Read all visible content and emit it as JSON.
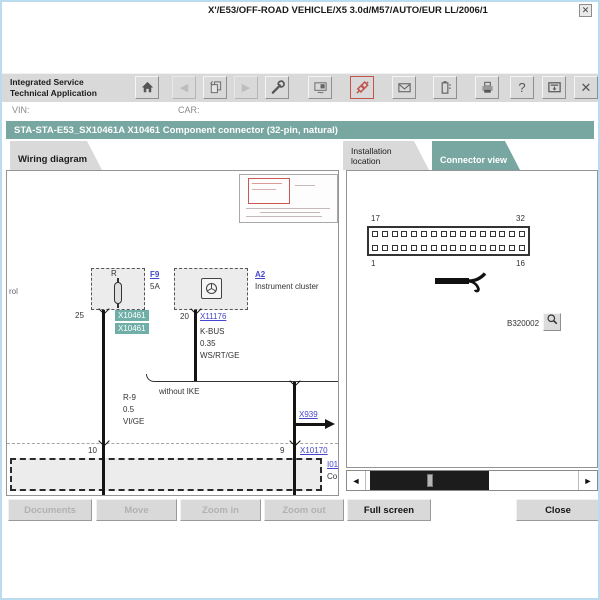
{
  "header": {
    "app_title_line1": "Integrated Service",
    "app_title_line2": "Technical Application",
    "toolbar": {
      "back_glyph": "◀",
      "forward_glyph": "▶",
      "help_glyph": "?",
      "close_glyph": "✕"
    }
  },
  "vehicle_bar": {
    "vin_label": "VIN:",
    "car_label": "CAR:",
    "car_value": "X'/E53/OFF-ROAD VEHICLE/X5 3.0d/M57/AUTO/EUR LL/2006/1"
  },
  "title_bar": {
    "title": "STA-STA-E53_SX10461A X10461 Component connector (32-pin, natural)",
    "close_glyph": "✕"
  },
  "tabs": {
    "wiring_diagram": {
      "label": "Wiring diagram"
    },
    "installation_location": {
      "label": "Installation location"
    },
    "connector_view": {
      "label": "Connector view"
    }
  },
  "wiring_panel": {
    "margin_note": "rol",
    "fuse": {
      "terminal": "R",
      "ref": "F9",
      "rating": "5A",
      "pin": "25",
      "highlight1": "X10461",
      "highlight2": "X10461"
    },
    "cluster": {
      "ref": "A2",
      "name": "Instrument cluster",
      "pin": "20",
      "connector_link": "X11176",
      "wire_line1": "K-BUS",
      "wire_line2": "0.35",
      "wire_line3": "WS/RT/GE"
    },
    "left_wire": {
      "line1": "R-9",
      "line2": "0.5",
      "line3": "VI/GE"
    },
    "branch_note": "without IKE",
    "x939_link": "X939",
    "pin_left": "10",
    "pin_right": "9",
    "x10170_link": "X10170",
    "component_ref": "I01",
    "component_text": "Co"
  },
  "connector_panel": {
    "pin_top_left": "17",
    "pin_top_right": "32",
    "pin_bottom_left": "1",
    "pin_bottom_right": "16",
    "rows": 2,
    "cols": 16,
    "figure_code": "B320002"
  },
  "scrollbar": {
    "left_glyph": "◄",
    "right_glyph": "►"
  },
  "footer_buttons": {
    "documents": "Documents",
    "move": "Move",
    "zoom_in": "Zoom in",
    "zoom_out": "Zoom out",
    "full_screen": "Full screen",
    "close": "Close"
  },
  "colors": {
    "accent_teal": "#78a7a1",
    "highlight_teal": "#6fafa8",
    "link_blue": "#4646cc",
    "alert_red": "#c0564e"
  }
}
